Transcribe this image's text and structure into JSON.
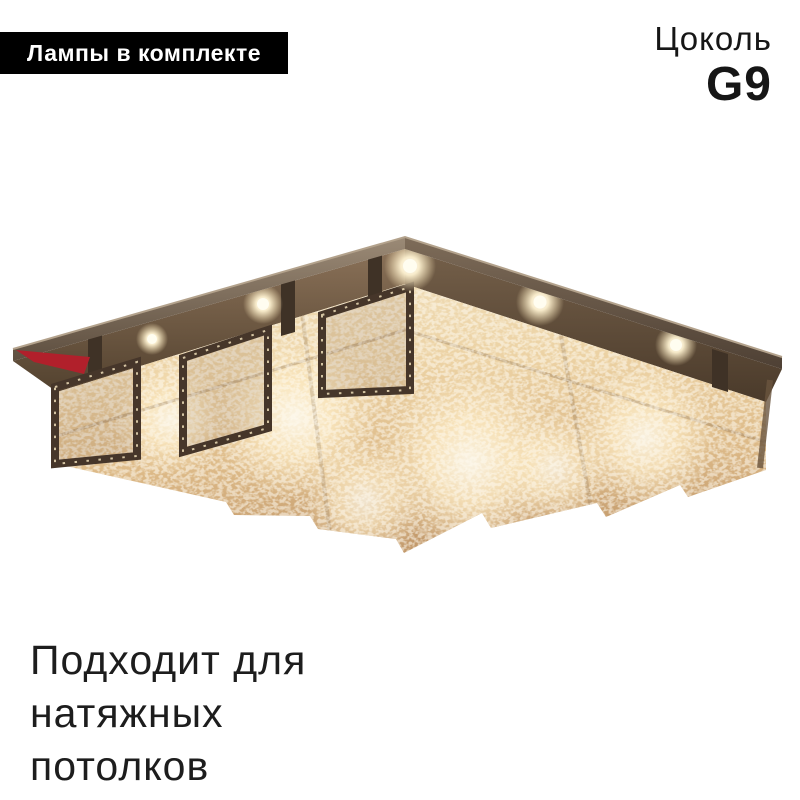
{
  "badge": {
    "label": "Лампы в комплекте"
  },
  "socket": {
    "label": "Цоколь",
    "value": "G9"
  },
  "note": {
    "lines": [
      "Подходит для",
      "натяжных",
      "потолков"
    ]
  },
  "image": {
    "alt": "crystal ceiling chandelier photo, square bronze plate with nine crystal-mesh boxes and glowing G9 bulbs, view from below"
  },
  "colors": {
    "background": "#ffffff",
    "badge-bg": "#000000",
    "badge-text": "#ffffff",
    "heading-text": "#161616",
    "note-text": "#1d1d1d",
    "accent-red": "#b1202b",
    "plate-bronze": "#6a594a",
    "frame-metal": "#46362a",
    "crystal-light": "#efdcb6",
    "crystal-deep": "#c39a6c",
    "glow-warm": "#ffeec8"
  }
}
